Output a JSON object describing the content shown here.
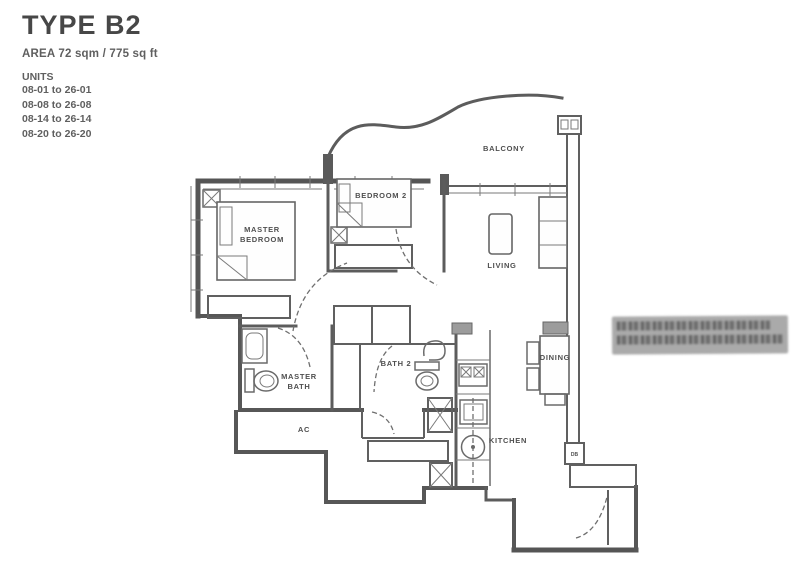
{
  "header": {
    "title": "TYPE B2",
    "area": "AREA  72 sqm / 775 sq ft",
    "units_heading": "UNITS",
    "units": [
      "08-01 to 26-01",
      "08-08 to 26-08",
      "08-14 to 26-14",
      "08-20 to 26-20"
    ]
  },
  "rooms": {
    "balcony": "BALCONY",
    "bedroom2": "BEDROOM 2",
    "master_bedroom": [
      "MASTER",
      "BEDROOM"
    ],
    "living": "LIVING",
    "dining": "DINING",
    "kitchen": "KITCHEN",
    "master_bath": [
      "MASTER",
      "BATH"
    ],
    "bath2": "BATH 2",
    "ac_ledge": "AC",
    "db": "DB"
  },
  "colors": {
    "ink": "#4c4c4c",
    "plan_line": "#5a5a5a",
    "background": "#ffffff",
    "watermark": "#a3a3a3"
  }
}
